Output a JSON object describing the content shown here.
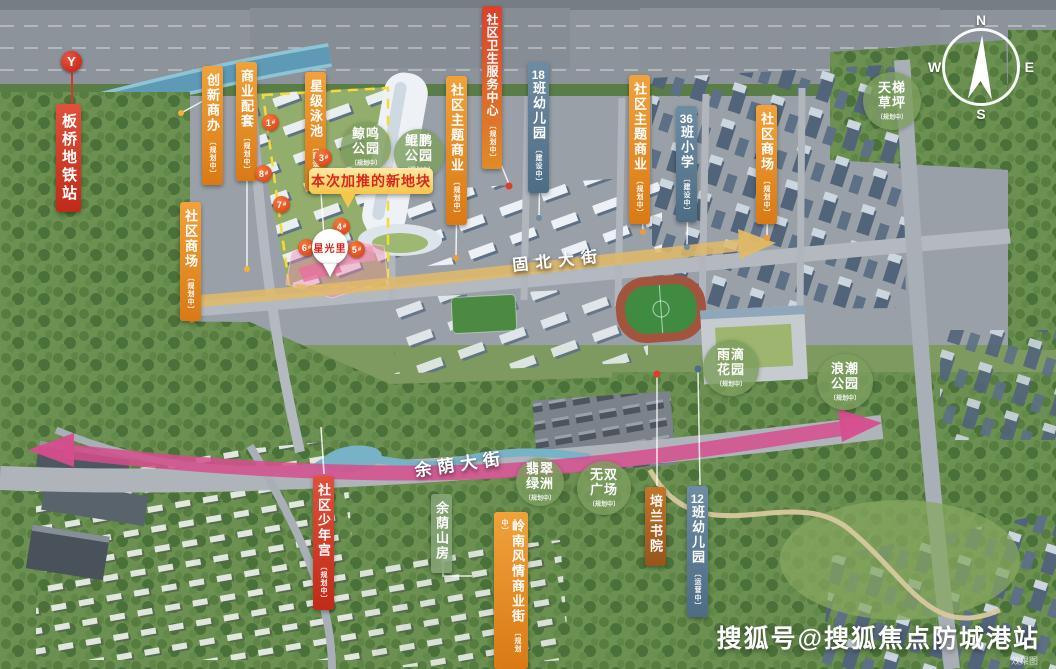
{
  "watermark": {
    "text": "搜狐号@搜狐焦点防城港站",
    "note": "效果图"
  },
  "compass": {
    "north": "N",
    "south": "S",
    "east": "E",
    "west": "W"
  },
  "metro": {
    "logo": "Y",
    "name": "板桥地铁站"
  },
  "project": {
    "name": "星光里"
  },
  "banner": {
    "text": "本次加推的新地块"
  },
  "roads": {
    "north_street": "固北大街",
    "south_street": "余荫大街"
  },
  "labels": [
    {
      "text": "创新商办",
      "status": "〔规划中〕"
    },
    {
      "text": "商业配套",
      "status": "〔规划中〕"
    },
    {
      "text": "星级泳池",
      "status": "〔建设中〕"
    },
    {
      "text": "社区商场",
      "status": "〔规划中〕"
    },
    {
      "text": "社区卫生服务中心",
      "status": "〔规划中〕"
    },
    {
      "text": "社区主题商业",
      "status": "〔规划中〕"
    },
    {
      "num": "18",
      "rest": "班幼儿园",
      "status": "〔建设中〕"
    },
    {
      "text": "社区主题商业",
      "status": "〔规划中〕"
    },
    {
      "num": "36",
      "rest": "班小学",
      "status": "〔建设中〕"
    },
    {
      "text": "社区商场",
      "status": "〔规划中〕"
    },
    {
      "text": "社区少年宫",
      "status": "〔规划中〕"
    },
    {
      "text": "余荫山房",
      "status": ""
    },
    {
      "text": "岭南风情商业街",
      "status": "〔规划中〕"
    },
    {
      "text": "培兰书院",
      "status": ""
    },
    {
      "num": "12",
      "rest": "班幼儿园",
      "status": "〔运营中〕"
    }
  ],
  "parks": [
    {
      "line1": "鲸鸣",
      "line2": "公园",
      "status": "〔规划中〕"
    },
    {
      "line1": "鲲鹏",
      "line2": "公园",
      "status": "〔规划中〕"
    },
    {
      "line1": "天梯",
      "line2": "草坪",
      "status": "〔规划中〕"
    },
    {
      "line1": "翡翠",
      "line2": "绿洲",
      "status": "〔规划中〕"
    },
    {
      "line1": "无双",
      "line2": "广场",
      "status": "〔规划中〕"
    },
    {
      "line1": "雨滴",
      "line2": "花园",
      "status": "〔规划中〕"
    },
    {
      "line1": "浪潮",
      "line2": "公园",
      "status": "〔规划中〕"
    }
  ],
  "badges": [
    {
      "n": "1",
      "s": "#"
    },
    {
      "n": "3",
      "s": "#"
    },
    {
      "n": "8",
      "s": "#"
    },
    {
      "n": "7",
      "s": "#"
    },
    {
      "n": "4",
      "s": "#"
    },
    {
      "n": "6",
      "s": "#"
    },
    {
      "n": "5",
      "s": "#"
    }
  ]
}
